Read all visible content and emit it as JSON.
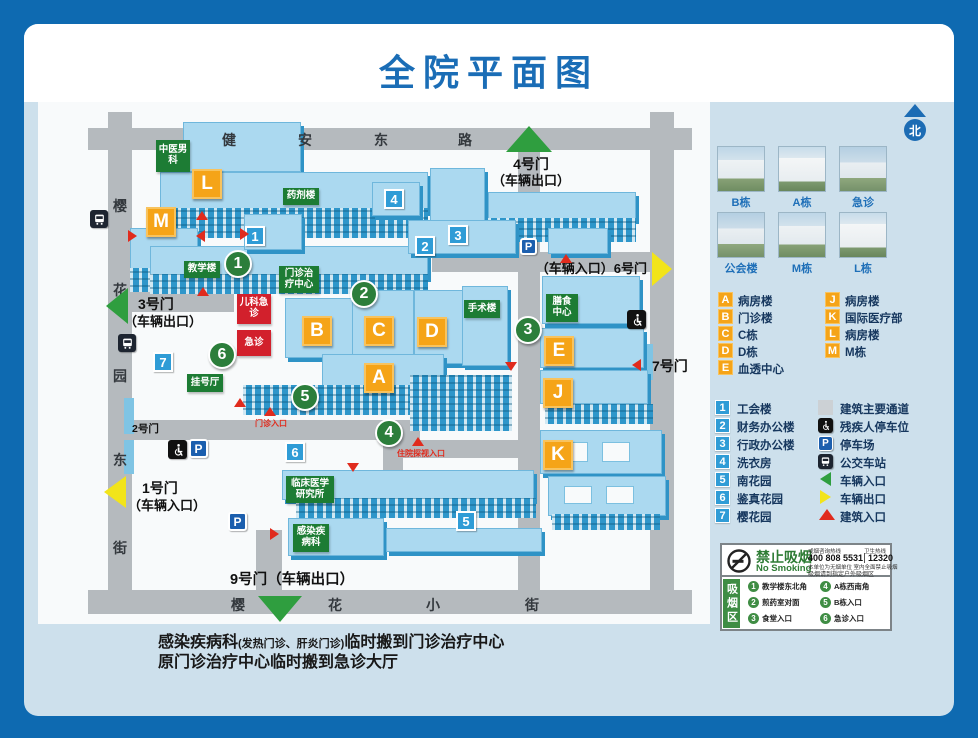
{
  "title": "全院平面图",
  "north_label": "北",
  "map": {
    "streets": {
      "top": [
        "健",
        "安",
        "东",
        "路"
      ],
      "left": [
        "樱",
        "花",
        "园",
        "东",
        "街"
      ],
      "bottom": [
        "樱",
        "花",
        "小",
        "街"
      ]
    },
    "gates": {
      "gate1": {
        "name": "1号门",
        "sub": "（车辆入口）"
      },
      "gate2": {
        "name": "2号门"
      },
      "gate3": {
        "name": "3号门",
        "sub": "（车辆出口）"
      },
      "gate4": {
        "name": "4号门",
        "sub": "（车辆出口）"
      },
      "gate6": {
        "label": "（车辆入口）6号门"
      },
      "gate7": {
        "name": "7号门"
      },
      "gate9": {
        "label": "9号门（车辆出口）"
      }
    },
    "letters": [
      "L",
      "M",
      "B",
      "C",
      "A",
      "D",
      "E",
      "J",
      "K"
    ],
    "site_numbers": [
      "1",
      "2",
      "3",
      "4",
      "5",
      "6",
      "7"
    ],
    "smoking_spots": [
      "1",
      "2",
      "3",
      "4",
      "5",
      "6"
    ],
    "labels": {
      "tcm": "中医男科",
      "pharmacy": "药剂楼",
      "teaching": "教学楼",
      "outpatient_center": "门诊治疗中心",
      "registration": "挂号厅",
      "surgery": "手术楼",
      "dining": "膳食中心",
      "clinical_institute": "临床医学研究所",
      "infectious": "感染疾病科",
      "pediatric_er": "儿科急诊",
      "er": "急诊",
      "outpatient_entrance": "门诊入口",
      "visit_entrance": "住院探视入口"
    },
    "parking_letter": "P"
  },
  "sidebar": {
    "photos": [
      {
        "label": "B栋"
      },
      {
        "label": "A栋"
      },
      {
        "label": "急诊"
      },
      {
        "label": "公会楼"
      },
      {
        "label": "M栋"
      },
      {
        "label": "L栋"
      }
    ],
    "letter_legend_left": [
      {
        "key": "A",
        "label": "病房楼"
      },
      {
        "key": "B",
        "label": "门诊楼"
      },
      {
        "key": "C",
        "label": "C栋"
      },
      {
        "key": "D",
        "label": "D栋"
      },
      {
        "key": "E",
        "label": "血透中心"
      }
    ],
    "letter_legend_right": [
      {
        "key": "J",
        "label": "病房楼"
      },
      {
        "key": "K",
        "label": "国际医疗部"
      },
      {
        "key": "L",
        "label": "病房楼"
      },
      {
        "key": "M",
        "label": "M栋"
      }
    ],
    "number_legend": [
      {
        "key": "1",
        "label": "工会楼"
      },
      {
        "key": "2",
        "label": "财务办公楼"
      },
      {
        "key": "3",
        "label": "行政办公楼"
      },
      {
        "key": "4",
        "label": "洗衣房"
      },
      {
        "key": "5",
        "label": "南花园"
      },
      {
        "key": "6",
        "label": "鉴真花园"
      },
      {
        "key": "7",
        "label": "樱花园"
      }
    ],
    "symbol_legend": [
      {
        "icon": "path-icon",
        "label": "建筑主要通道"
      },
      {
        "icon": "wheelchair-icon",
        "label": "残疾人停车位"
      },
      {
        "icon": "parking-icon",
        "label": "停车场"
      },
      {
        "icon": "bus-icon",
        "label": "公交车站"
      },
      {
        "icon": "vehicle-entrance-arrow",
        "label": "车辆入口"
      },
      {
        "icon": "vehicle-exit-arrow",
        "label": "车辆出口"
      },
      {
        "icon": "building-entrance-arrow",
        "label": "建筑入口"
      }
    ],
    "no_smoking": {
      "title": "禁止吸烟",
      "subtitle": "No Smoking",
      "hotline1_label": "戒烟咨询热线",
      "hotline1": "400 808 5531",
      "hotline2_label": "卫生热线",
      "hotline2": "12320",
      "note1": "本单位为无烟单位 室内全面禁止吸烟",
      "note2": "吸烟请到指定户外吸烟区",
      "zone_band": "吸烟区",
      "zones": [
        {
          "n": "1",
          "label": "教学楼东北角"
        },
        {
          "n": "2",
          "label": "煎药室对面"
        },
        {
          "n": "3",
          "label": "食堂入口"
        },
        {
          "n": "4",
          "label": "A栋西南角"
        },
        {
          "n": "5",
          "label": "B栋入口"
        },
        {
          "n": "6",
          "label": "急诊入口"
        }
      ]
    }
  },
  "footer": {
    "line1_name": "感染疾病科",
    "line1_paren": "(发热门诊、肝炎门诊)",
    "line1_rest": "临时搬到门诊治疗中心",
    "line2": "原门诊治疗中心临时搬到急诊大厅"
  }
}
